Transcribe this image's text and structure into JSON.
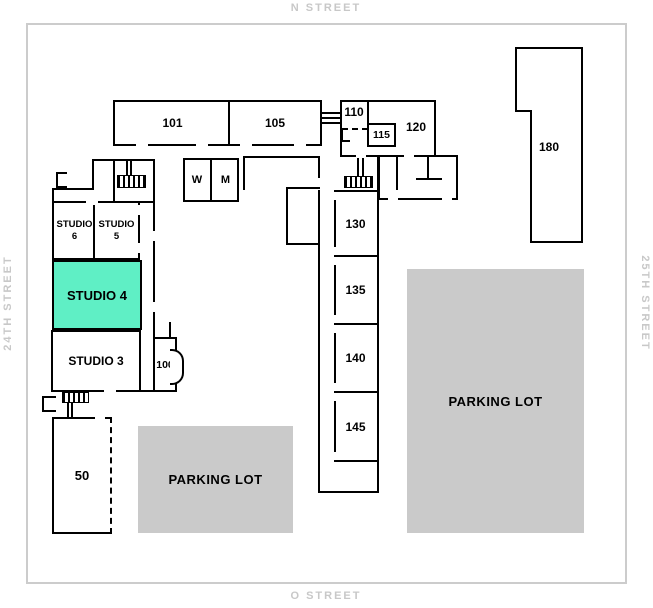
{
  "streets": {
    "north": "N STREET",
    "south": "O STREET",
    "west": "24TH STREET",
    "east": "25TH STREET"
  },
  "rooms": {
    "room_101": "101",
    "room_105": "105",
    "room_110": "110",
    "room_115": "115",
    "room_120": "120",
    "room_130": "130",
    "room_135": "135",
    "room_140": "140",
    "room_145": "145",
    "room_180": "180",
    "room_100": "100",
    "room_50": "50",
    "restroom_w": "W",
    "restroom_m": "M",
    "studio_6": "STUDIO\n6",
    "studio_5": "STUDIO\n5",
    "studio_4": "STUDIO 4",
    "studio_3": "STUDIO 3"
  },
  "parking": {
    "label": "PARKING LOT"
  },
  "highlight": {
    "room": "STUDIO 4",
    "color": "#5FEFC5"
  },
  "colors": {
    "wall": "#000000",
    "parking_fill": "#CACACA",
    "street_text": "#C8C8C8",
    "map_border": "#CCCCCC"
  }
}
